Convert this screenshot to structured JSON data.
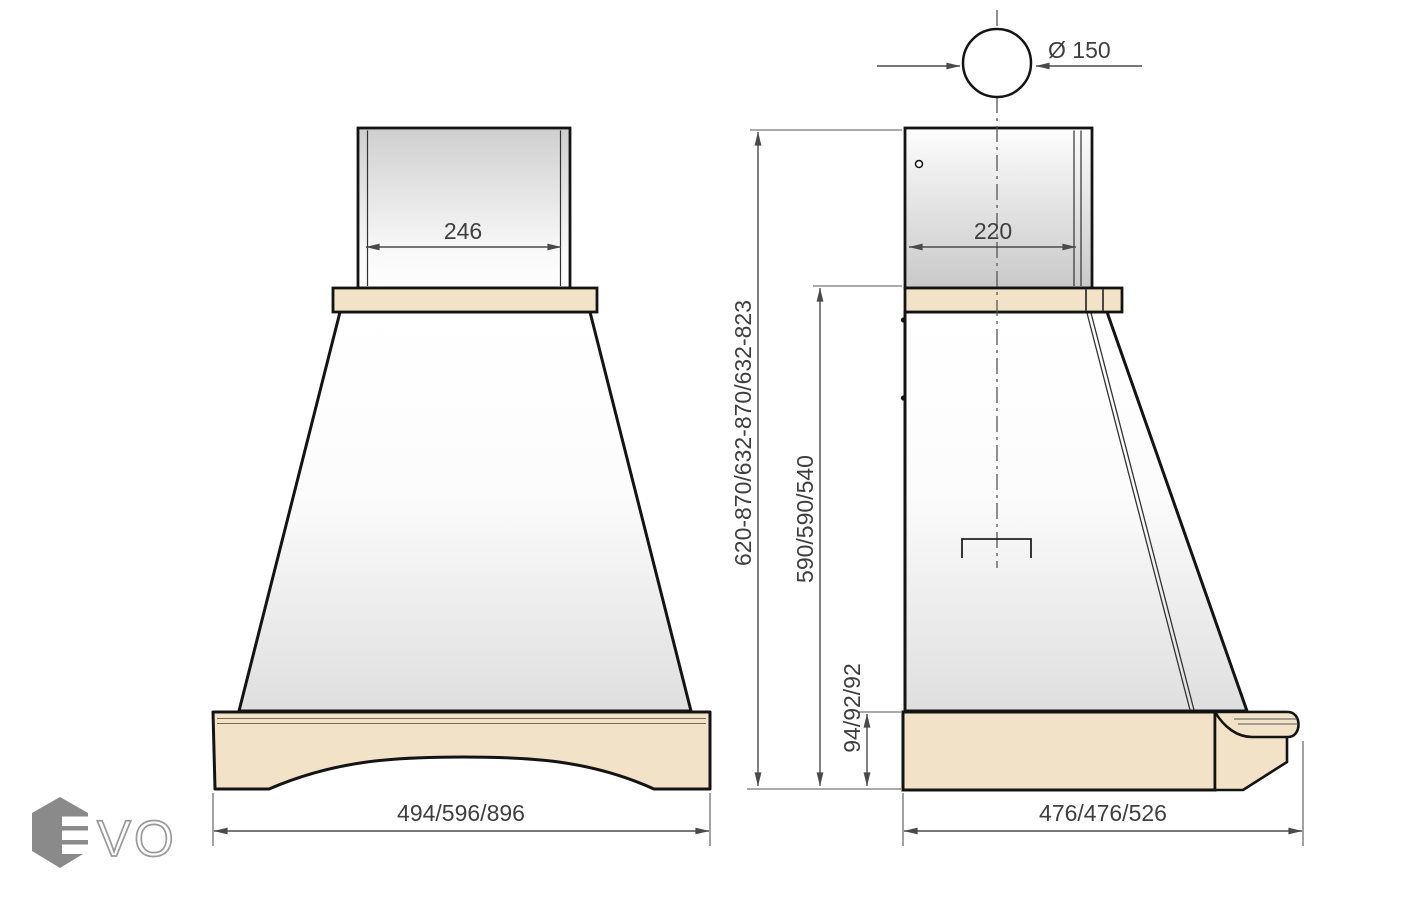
{
  "drawing": {
    "type": "technical-dimension-drawing",
    "subject": "kitchen cooker hood, front and side views"
  },
  "colors": {
    "background": "#ffffff",
    "wood_trim": "#f2e3c8",
    "outline": "#141414",
    "dimension": "#4a4a4a",
    "logo_gray": "#8a8a8a"
  },
  "front_view": {
    "chimney_width": "246",
    "width": "494/596/896"
  },
  "side_view": {
    "chimney_depth": "220",
    "depth": "476/476/526",
    "duct_diameter": "Ø 150"
  },
  "heights": {
    "total": "620-870/632-870/632-823",
    "body": "590/590/540",
    "base": "94/92/92"
  },
  "logo": {
    "vo": "VO"
  }
}
